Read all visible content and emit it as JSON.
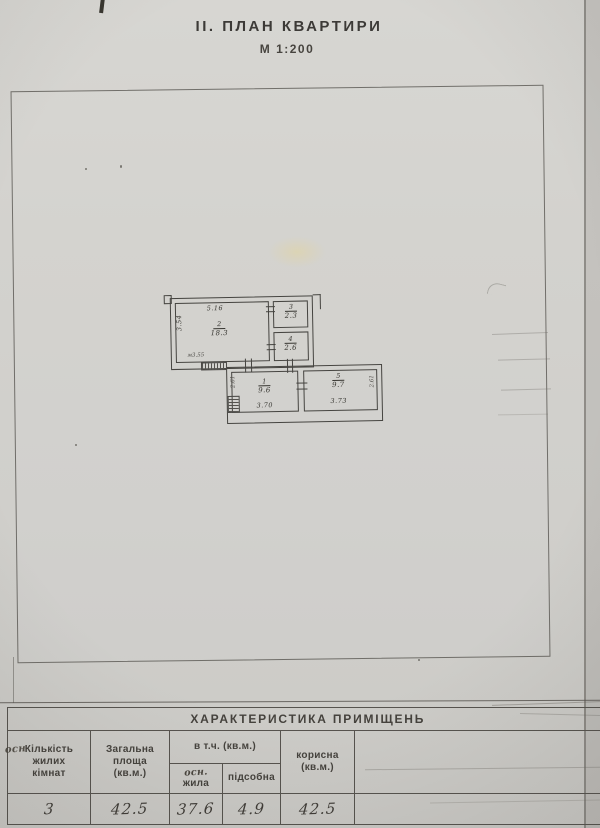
{
  "page": {
    "title": "ІІ. ПЛАН КВАРТИРИ",
    "scale": "М 1:200"
  },
  "plan": {
    "rooms": [
      {
        "number": "1",
        "area": "9.6",
        "bottom_dim": "3.70",
        "side_dim": "2.61"
      },
      {
        "number": "2",
        "area": "18.3",
        "top_dim": "5.16",
        "side_dim": "3.54",
        "bottom_note": "м3.55"
      },
      {
        "number": "3",
        "area": "2.3"
      },
      {
        "number": "4",
        "area": "2.6"
      },
      {
        "number": "5",
        "area": "9.7",
        "bottom_dim": "3.73",
        "side_dim": "2.61"
      }
    ]
  },
  "table": {
    "title": "ХАРАКТЕРИСТИКА ПРИМІЩЕНЬ",
    "headers": {
      "col1": [
        "Кількість",
        "жилих",
        "кімнат"
      ],
      "col1_handwritten": "осн",
      "col2": [
        "Загальна",
        "площа",
        "(кв.м.)"
      ],
      "col3": "в т.ч. (кв.м.)",
      "col3a_handwritten": "осн.",
      "col3a": "жила",
      "col3b": "підсобна",
      "col4": [
        "корисна",
        "(кв.м.)"
      ]
    },
    "values": {
      "rooms_count": "3",
      "total_area": "42.5",
      "living_area": "37.6",
      "auxiliary_area": "4.9",
      "useful_area": "42.5"
    }
  }
}
